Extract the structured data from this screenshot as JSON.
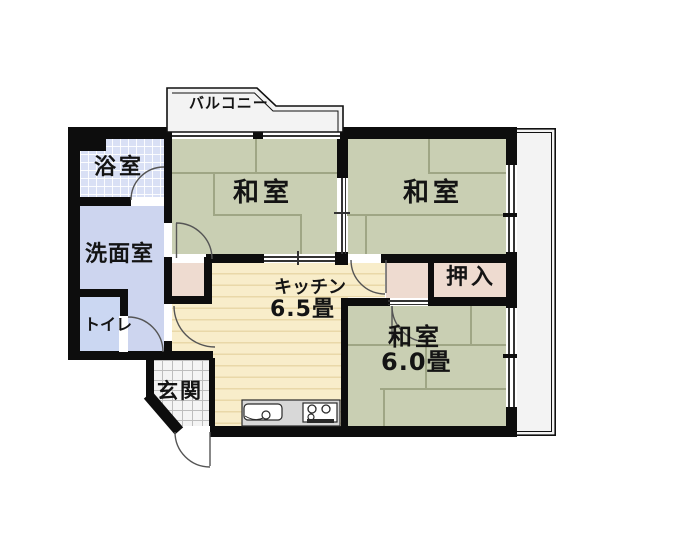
{
  "floorplan": {
    "title": "apartment-floor-plan",
    "balcony": {
      "label": "バルコニー"
    },
    "rooms": {
      "bath": {
        "label": "浴室"
      },
      "washroom": {
        "label": "洗面室"
      },
      "toilet": {
        "label": "トイレ"
      },
      "genkan": {
        "label": "玄関"
      },
      "kitchen": {
        "label": "キッチン",
        "size": "6.5畳"
      },
      "washitsu1": {
        "label": "和室"
      },
      "washitsu2": {
        "label": "和室"
      },
      "washitsu3": {
        "label": "和室",
        "size": "6.0畳"
      },
      "oshiire": {
        "label": "押入"
      }
    },
    "fixtures": {
      "sink": "sink-icon",
      "stove": "stove-icon"
    },
    "colors": {
      "wall": "#0d0d0d",
      "tatami": "#c9cfb3",
      "tatami_line": "#9fa685",
      "kitchen_floor": "#f8edca",
      "kitchen_stripe": "#e9d8a8",
      "closet_pink": "#eedbd0",
      "washroom_blue": "#cdd5ef",
      "toilet_blue": "#cbd7f2",
      "bath_tile": "#d9e0f5",
      "balcony_fill": "#f3f3f3",
      "counter_grey": "#d8d8d8"
    }
  }
}
